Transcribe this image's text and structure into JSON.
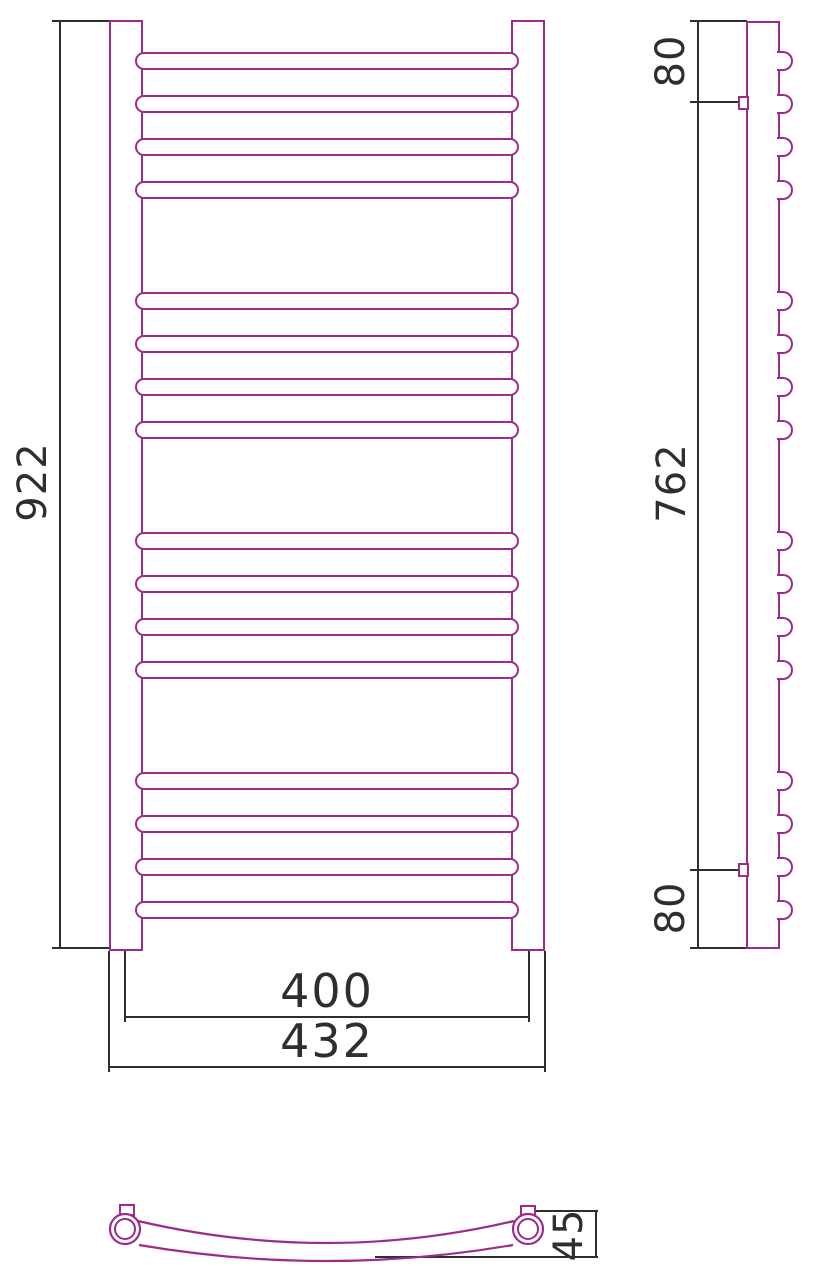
{
  "drawing": {
    "type": "towel-rail-three-view-technical-drawing",
    "front": {
      "height": "922",
      "rail_center_width": "400",
      "overall_width": "432"
    },
    "side": {
      "top_bracket_offset": "80",
      "bracket_span": "762",
      "bottom_bracket_offset": "80"
    },
    "plan": {
      "bow_depth": "45"
    }
  },
  "colors": {
    "outline": "#9b2c8b",
    "dim": "#2e2e2e",
    "background": "#ffffff"
  }
}
